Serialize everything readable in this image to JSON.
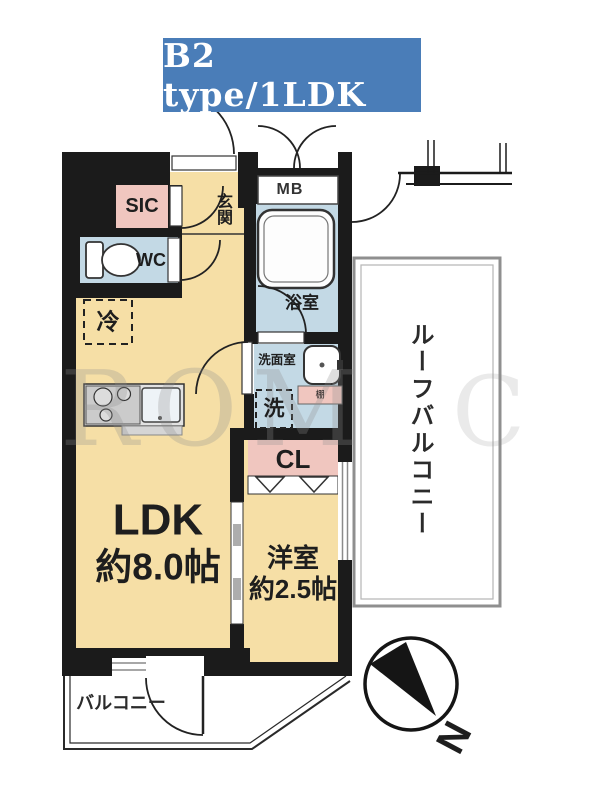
{
  "title": {
    "label": "B2 type/1LDK"
  },
  "colors": {
    "banner_bg": "#4a7db8",
    "banner_text": "#ffffff",
    "room": "#f6dfa6",
    "closet_pink": "#f0c6bf",
    "wet_area_blue": "#c3d9e5",
    "wall": "#1b1b1b",
    "balcony_border": "#8f8f8f"
  },
  "plan": {
    "rooms": {
      "sic": {
        "label": "SIC"
      },
      "entrance": {
        "label": "玄関"
      },
      "meter_box": {
        "label": "MB"
      },
      "toilet": {
        "label": "WC"
      },
      "bathroom": {
        "label": "浴室"
      },
      "refrigerator": {
        "label": "冷"
      },
      "washroom": {
        "label": "洗面室"
      },
      "washer": {
        "label": "洗"
      },
      "shelf": {
        "label": "棚"
      },
      "closet": {
        "label": "CL"
      },
      "ldk": {
        "label": "LDK",
        "size": "約8.0帖"
      },
      "western_room": {
        "label": "洋室",
        "size": "約2.5帖"
      },
      "roof_balcony": {
        "label": "ルーフバルコニー"
      },
      "balcony": {
        "label": "バルコニー"
      }
    },
    "compass": {
      "north_label": "N"
    },
    "watermark": {
      "text": "ROM",
      "text2": "C"
    }
  }
}
